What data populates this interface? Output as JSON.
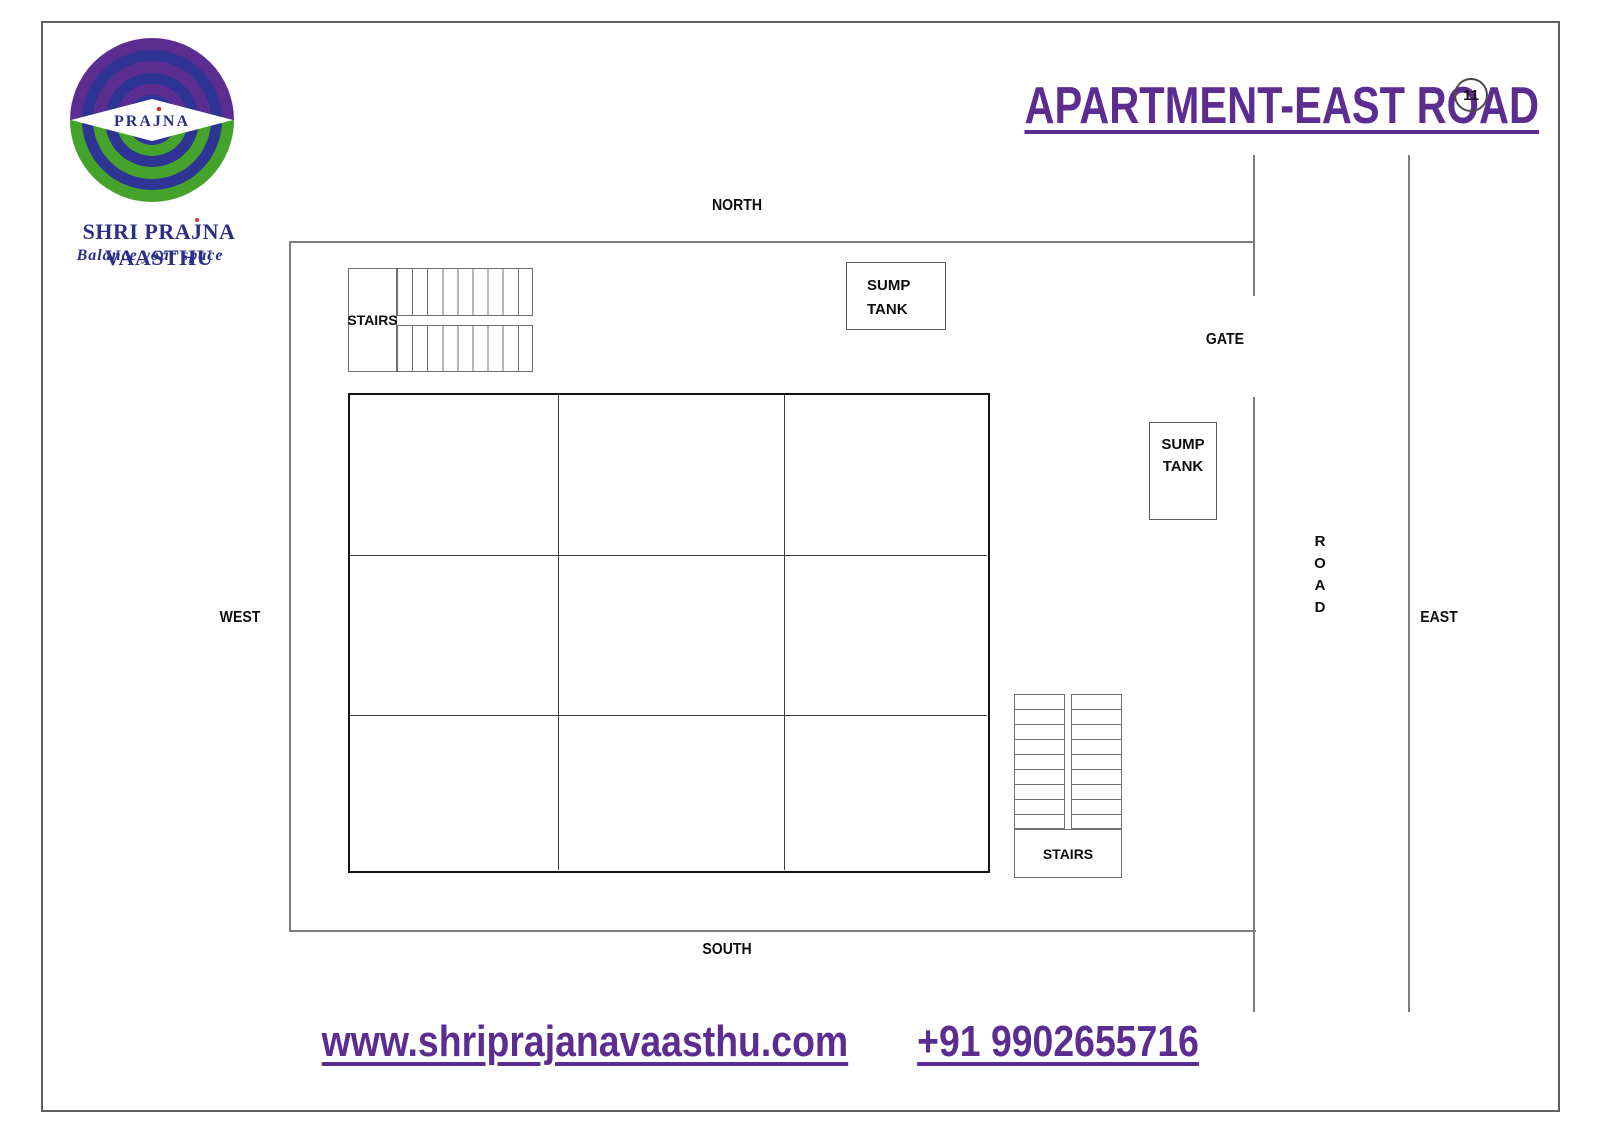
{
  "branding": {
    "logo_word": "PRAJNA",
    "company_pre": "SHRI PRA",
    "company_j": "J",
    "company_post": "NA VAASTHU",
    "tagline": "Balance your space"
  },
  "header": {
    "title": "APARTMENT-EAST ROAD",
    "page_number": "11"
  },
  "compass": {
    "north": "NORTH",
    "south": "SOUTH",
    "west": "WEST",
    "east": "EAST"
  },
  "plot": {
    "gate": "GATE",
    "road": [
      "R",
      "O",
      "A",
      "D"
    ],
    "stairs_nw": "STAIRS",
    "stairs_se": "STAIRS",
    "sump_north": {
      "line1": "SUMP",
      "line2": "TANK"
    },
    "sump_east": {
      "line1": "SUMP",
      "line2": "TANK"
    }
  },
  "footer": {
    "website": "www.shriprajanavaasthu.com",
    "phone": "+91 9902655716"
  },
  "colors": {
    "purple": "#5c2d91",
    "navy": "#2b3087",
    "green": "#45a22b",
    "red_dot": "#cf3730",
    "line_gray": "#7d7d7d"
  }
}
